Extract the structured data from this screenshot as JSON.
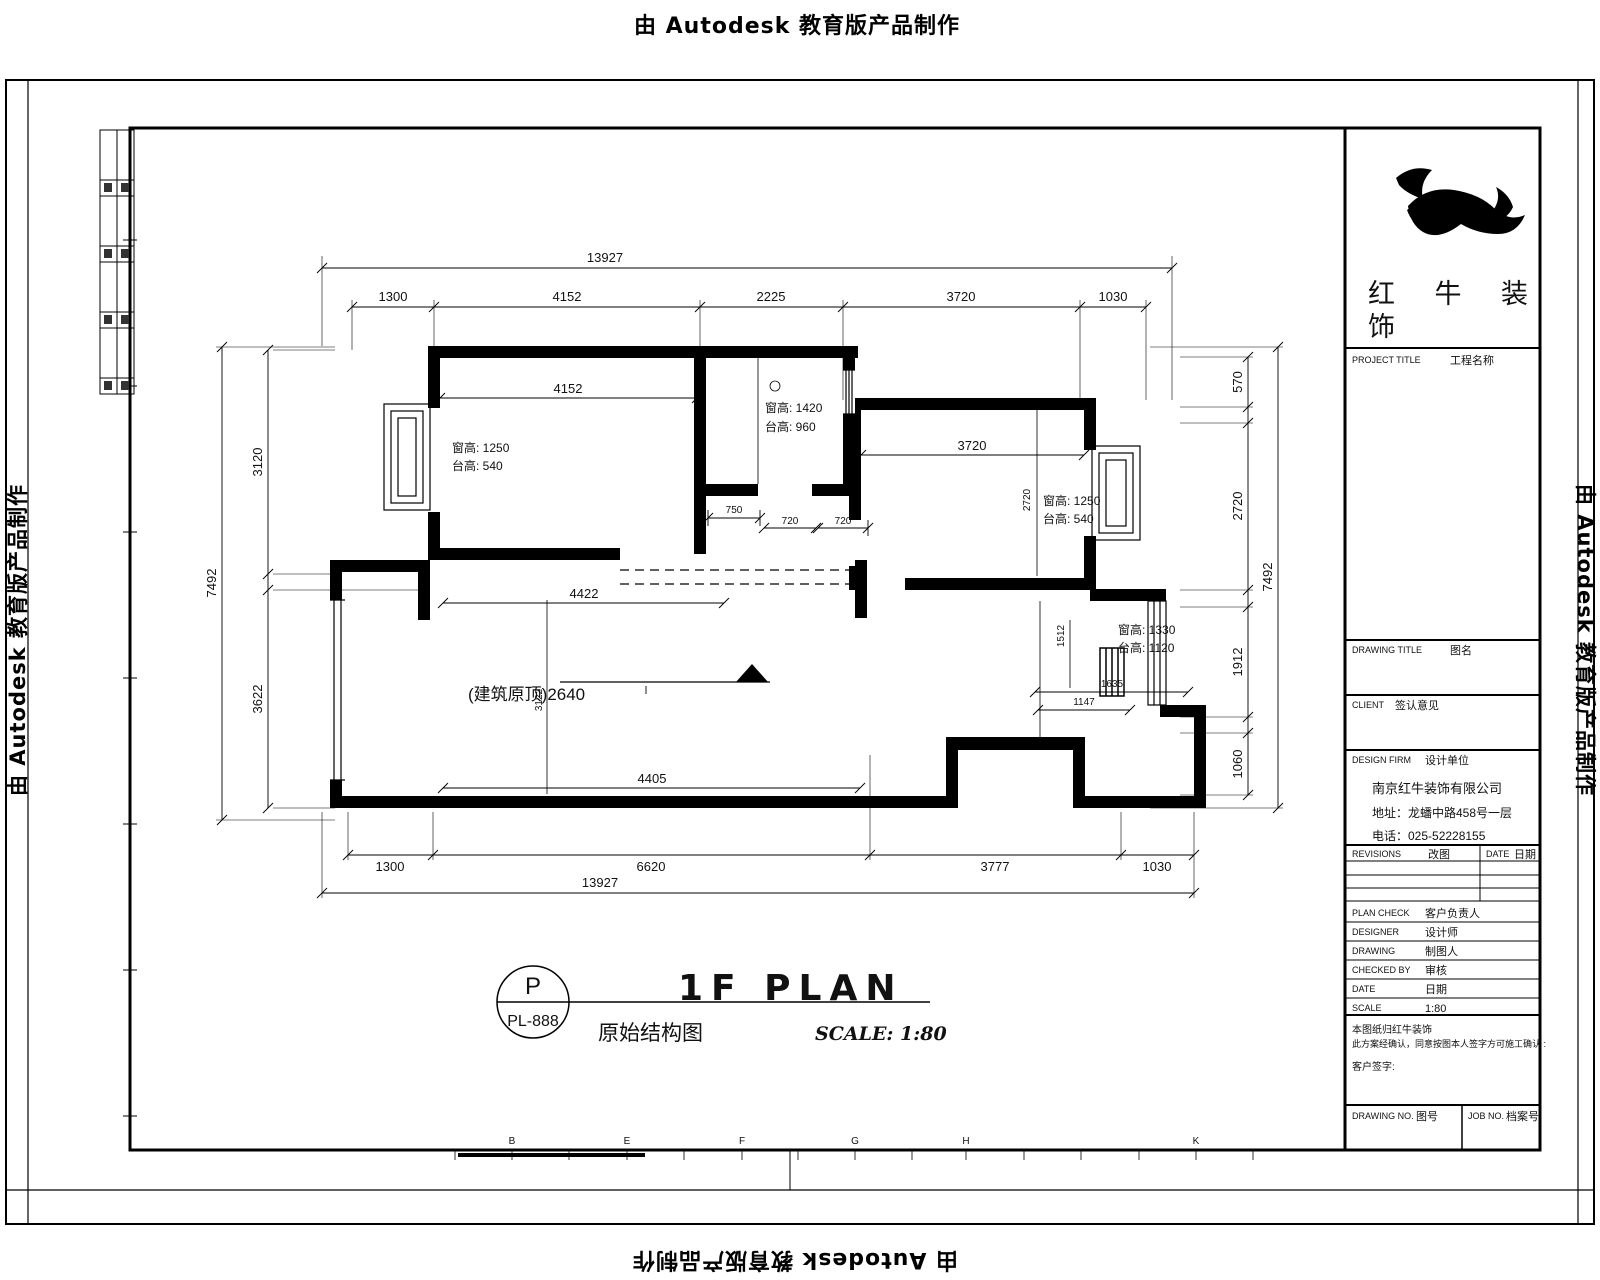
{
  "watermark": {
    "text": "由 Autodesk 教育版产品制作"
  },
  "plan": {
    "dims_top": {
      "overall": "13927",
      "segments": [
        "1300",
        "4152",
        "2225",
        "3720",
        "1030"
      ]
    },
    "dims_bottom": {
      "overall": "13927",
      "segments": [
        "1300",
        "6620",
        "3777",
        "1030"
      ]
    },
    "dims_left": {
      "overall": "7492",
      "segments": [
        "3120",
        "3622"
      ]
    },
    "dims_right": {
      "overall": "7492",
      "segments": [
        "570",
        "2720",
        "1912",
        "1060"
      ]
    },
    "interior": {
      "bed1_dim": "4152",
      "bed1_win_h": "窗高: 1250",
      "bed1_sill_h": "台高: 540",
      "bath_win_h": "窗高: 1420",
      "bath_sill_h": "台高: 960",
      "bed2_dim": "3720",
      "bed2_vdim": "2720",
      "bed2_win_h": "窗高: 1250",
      "bed2_sill_h": "台高: 540",
      "kit_win_h": "窗高: 1330",
      "kit_sill_h": "台高: 1120",
      "kit_dim1": "1635",
      "kit_dim2": "1147",
      "kit_vdim": "1512",
      "living_dim_top": "4422",
      "living_dim_bottom": "4405",
      "living_vdim": "3122",
      "level_label": "(建筑原顶)2640",
      "door_dims": [
        "750",
        "720",
        "720"
      ]
    },
    "grid_letters": [
      "B",
      "E",
      "F",
      "G",
      "H",
      "K"
    ]
  },
  "drawing_label": {
    "circle_top": "P",
    "circle_bottom": "PL-888",
    "title": "1F PLAN",
    "subtitle": "原始结构图",
    "scale": "SCALE: 1:80"
  },
  "title_block": {
    "brand_line1": "红 牛 装",
    "brand_line2": "饰",
    "project_title": {
      "en": "PROJECT TITLE",
      "cn": "工程名称"
    },
    "drawing_title": {
      "en": "DRAWING TITLE",
      "cn": "图名"
    },
    "client": {
      "en": "CLIENT",
      "cn": "签认意见"
    },
    "design_firm": {
      "en": "DESIGN FIRM",
      "cn": "设计单位"
    },
    "company": {
      "name": "南京红牛装饰有限公司",
      "address": "地址：龙蟠中路458号一层",
      "phone": "电话：025-52228155"
    },
    "revisions": {
      "en": "REVISIONS",
      "cn": "改图"
    },
    "rev_date": {
      "en": "DATE",
      "cn": "日期"
    },
    "rows": [
      {
        "en": "PLAN CHECK",
        "cn": "客户负责人"
      },
      {
        "en": "DESIGNER",
        "cn": "设计师"
      },
      {
        "en": "DRAWING",
        "cn": "制图人"
      },
      {
        "en": "CHECKED BY",
        "cn": "审核"
      },
      {
        "en": "DATE",
        "cn": "日期"
      },
      {
        "en": "SCALE",
        "cn": "1:80"
      }
    ],
    "notes": [
      "本图纸归红牛装饰",
      "此方案经确认，同意按图本人签字方可施工确认 :",
      "客户签字:"
    ],
    "drawing_no": {
      "en": "DRAWING NO.",
      "cn": "图号"
    },
    "job_no": {
      "en": "JOB NO.",
      "cn": "档案号"
    }
  }
}
